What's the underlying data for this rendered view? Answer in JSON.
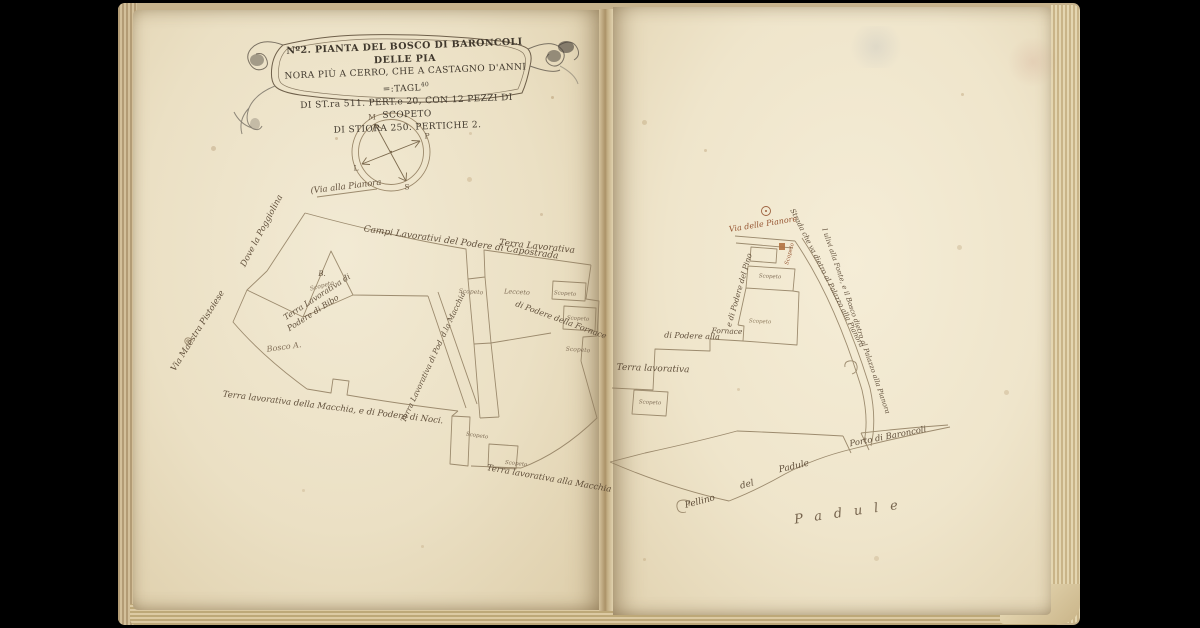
{
  "palette": {
    "page": "#efe5cd",
    "ink": "#55432f",
    "red_ink": "#8f4a26",
    "pencil": "#8d8678"
  },
  "cartouche": {
    "lines": [
      "Nº2. PIANTA DEL BOSCO DI BARONCOLI DELLE PIA",
      "NORA PIÙ A CERRO, CHE A CASTAGNO D'ANNI =:TAGL",
      "DI ST.ra 511. PERT.e 20, CON 12 PEZZI DI SCOPETO",
      "DI STIORA 250. PERTICHE 2."
    ],
    "sup": "40"
  },
  "compass": {
    "points": [
      {
        "label": "M",
        "x": 372,
        "y": 117
      },
      {
        "label": "P",
        "x": 427,
        "y": 136
      },
      {
        "label": "L",
        "x": 356,
        "y": 168
      },
      {
        "label": "S",
        "x": 407,
        "y": 187
      }
    ]
  },
  "map_labels": [
    {
      "text": "(Via alla Pianora",
      "x": 346,
      "y": 187,
      "rot": -7,
      "size": 8.5
    },
    {
      "text": "Dove la Poggiolina",
      "x": 262,
      "y": 231,
      "rot": -62,
      "size": 8.5
    },
    {
      "text": "Campi Lavorativi del Podere di Capostrada",
      "x": 461,
      "y": 243,
      "rot": 8,
      "size": 9
    },
    {
      "text": "Terra Lavorativa",
      "x": 537,
      "y": 247,
      "rot": 6,
      "size": 9
    },
    {
      "text": "Terra Lavorativa di",
      "x": 317,
      "y": 297,
      "rot": -33,
      "size": 8
    },
    {
      "text": "Podere di Bibo",
      "x": 313,
      "y": 313,
      "rot": -33,
      "size": 8
    },
    {
      "text": "B.",
      "x": 322,
      "y": 274,
      "rot": 0,
      "size": 7
    },
    {
      "text": "Scopeto",
      "x": 322,
      "y": 286,
      "rot": -15,
      "size": 6,
      "color": "#7a6750"
    },
    {
      "text": "Via Maestra Pistoiese",
      "x": 198,
      "y": 331,
      "rot": -58,
      "size": 8.5
    },
    {
      "text": "Bosco A.",
      "x": 284,
      "y": 347,
      "rot": -8,
      "size": 8,
      "color": "#7a6750"
    },
    {
      "text": "Scopeto",
      "x": 471,
      "y": 292,
      "rot": 4,
      "size": 6,
      "color": "#7a6750"
    },
    {
      "text": "Lecceto",
      "x": 517,
      "y": 292,
      "rot": 3,
      "size": 6.5,
      "color": "#7a6750"
    },
    {
      "text": "Terra Lavorativa di Pod. d.la Macchia",
      "x": 433,
      "y": 357,
      "rot": -65,
      "size": 7.5
    },
    {
      "text": "di Podere della Fornace",
      "x": 561,
      "y": 320,
      "rot": 20,
      "size": 8
    },
    {
      "text": "Scopeto",
      "x": 565,
      "y": 294,
      "rot": 4,
      "size": 5.5,
      "color": "#7a6750"
    },
    {
      "text": "Scopeto",
      "x": 578,
      "y": 319,
      "rot": 4,
      "size": 5.5,
      "color": "#7a6750"
    },
    {
      "text": "Scopeto",
      "x": 578,
      "y": 350,
      "rot": 4,
      "size": 6,
      "color": "#7a6750"
    },
    {
      "text": "Terra lavorativa della Macchia, e di Podere di Noci.",
      "x": 333,
      "y": 408,
      "rot": 7,
      "size": 8.5
    },
    {
      "text": "Scopeto",
      "x": 477,
      "y": 436,
      "rot": 8,
      "size": 5.5,
      "color": "#7a6750"
    },
    {
      "text": "Scopeto",
      "x": 516,
      "y": 464,
      "rot": 6,
      "size": 5.5,
      "color": "#7a6750"
    },
    {
      "text": "Terra lavorativa alla Macchia",
      "x": 549,
      "y": 479,
      "rot": 10,
      "size": 8.5
    },
    {
      "text": "Via delle Pianore",
      "x": 763,
      "y": 224,
      "rot": -9,
      "size": 8,
      "color": "#8f4a26"
    },
    {
      "text": "Scopeto",
      "x": 790,
      "y": 254,
      "rot": -75,
      "size": 5.5,
      "color": "#8f4a26"
    },
    {
      "text": "Scopeto",
      "x": 770,
      "y": 277,
      "rot": 3,
      "size": 5.5,
      "color": "#7a6750"
    },
    {
      "text": "e di Podere del Pino",
      "x": 739,
      "y": 290,
      "rot": -74,
      "size": 7.5
    },
    {
      "text": "Fornace",
      "x": 727,
      "y": 331,
      "rot": 2,
      "size": 7.5
    },
    {
      "text": "di Podere alla",
      "x": 692,
      "y": 336,
      "rot": 2,
      "size": 8
    },
    {
      "text": "Scopeto",
      "x": 760,
      "y": 322,
      "rot": 3,
      "size": 5.5,
      "color": "#8a7658"
    },
    {
      "text": "Terra lavorativa",
      "x": 653,
      "y": 369,
      "rot": 2,
      "size": 9
    },
    {
      "text": "Scopeto",
      "x": 650,
      "y": 403,
      "rot": 3,
      "size": 5.5,
      "color": "#7a6750"
    },
    {
      "text": "Strada che va dietro al Palazzo alla Pianora",
      "x": 827,
      "y": 278,
      "rot": 63,
      "size": 7
    },
    {
      "text": "I ulivi alla Fonte, e il Bosco dietro al Palazzo alla Pianora",
      "x": 856,
      "y": 321,
      "rot": 71,
      "size": 6.8
    },
    {
      "text": "Porto di Baroncoli",
      "x": 888,
      "y": 437,
      "rot": -11,
      "size": 8.5
    },
    {
      "text": "Pellino",
      "x": 700,
      "y": 502,
      "rot": -15,
      "size": 9
    },
    {
      "text": "del",
      "x": 747,
      "y": 485,
      "rot": -15,
      "size": 9
    },
    {
      "text": "Padule",
      "x": 794,
      "y": 467,
      "rot": -13,
      "size": 9
    },
    {
      "text": "Padule",
      "x": 852,
      "y": 512,
      "rot": -8,
      "size": 13,
      "spacing": 12,
      "color": "#6b5842"
    }
  ]
}
